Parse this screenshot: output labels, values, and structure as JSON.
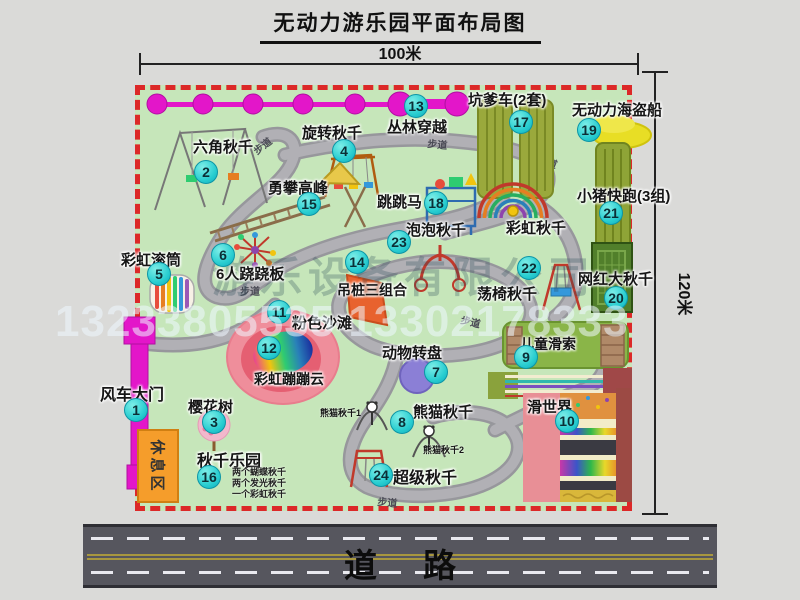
{
  "page": {
    "title": "无动力游乐园平面布局图",
    "top_dimension": "100米",
    "right_dimension": "120米"
  },
  "road": {
    "label": "道路"
  },
  "watermarks": {
    "company": "游乐设备有限公司",
    "phone": "13233805535 13302178333"
  },
  "map": {
    "path_label": "步道",
    "rest_area_label": "休息区",
    "colors": {
      "map_bg": "#c6e6ba",
      "border_red": "#dc2828",
      "badge_cyan": "#28cdd0",
      "magenta": "#e316c9",
      "olive_green": "#97a83a",
      "dark_green": "#517f2b",
      "pink": "#ef8e9b",
      "orange": "#f59d2b",
      "purple": "#8b7fd6",
      "yellow": "#e8de25"
    },
    "pois": {
      "p1": {
        "num": "1",
        "name": "风车大门"
      },
      "p2": {
        "num": "2",
        "name": "六角秋千"
      },
      "p3": {
        "num": "3",
        "name": "樱花树"
      },
      "p4": {
        "num": "4",
        "name": "旋转秋千"
      },
      "p5": {
        "num": "5",
        "name": "彩虹滚筒"
      },
      "p6": {
        "num": "6",
        "name": "6人跷跷板"
      },
      "p7": {
        "num": "7",
        "name": "动物转盘"
      },
      "p8": {
        "num": "8",
        "name": "熊猫秋千"
      },
      "p9": {
        "num": "9",
        "name": "儿童滑索"
      },
      "p10": {
        "num": "10",
        "name": "滑世界"
      },
      "p11": {
        "num": "11",
        "name": "粉色沙滩"
      },
      "p12": {
        "num": "12",
        "name": "彩虹蹦蹦云"
      },
      "p13": {
        "num": "13",
        "name": "丛林穿越"
      },
      "p14": {
        "num": "14",
        "name": "吊桩三组合"
      },
      "p15": {
        "num": "15",
        "name": "勇攀高峰"
      },
      "p16": {
        "num": "16",
        "name": "秋千乐园"
      },
      "p17": {
        "num": "17",
        "name": "坑爹车(2套)"
      },
      "p18": {
        "num": "18",
        "name": "跳跳马"
      },
      "p19": {
        "num": "19",
        "name": "无动力海盗船"
      },
      "p20": {
        "num": "20",
        "name": "网红大秋千"
      },
      "p21": {
        "num": "21",
        "name": "小猪快跑(3组)"
      },
      "p22": {
        "num": "22",
        "name": "荡椅秋千"
      },
      "p23": {
        "num": "23",
        "name": "泡泡秋千"
      },
      "p24": {
        "num": "24",
        "name": "超级秋千"
      },
      "rainbow_swing": {
        "name": "彩虹秋千"
      }
    },
    "sub_labels": {
      "panda1": "熊猫秋千1",
      "panda2": "熊猫秋千2"
    },
    "swing_park_notes": {
      "line1": "两个蝴蝶秋千",
      "line2": "两个发光秋千",
      "line3": "一个彩虹秋千"
    }
  }
}
